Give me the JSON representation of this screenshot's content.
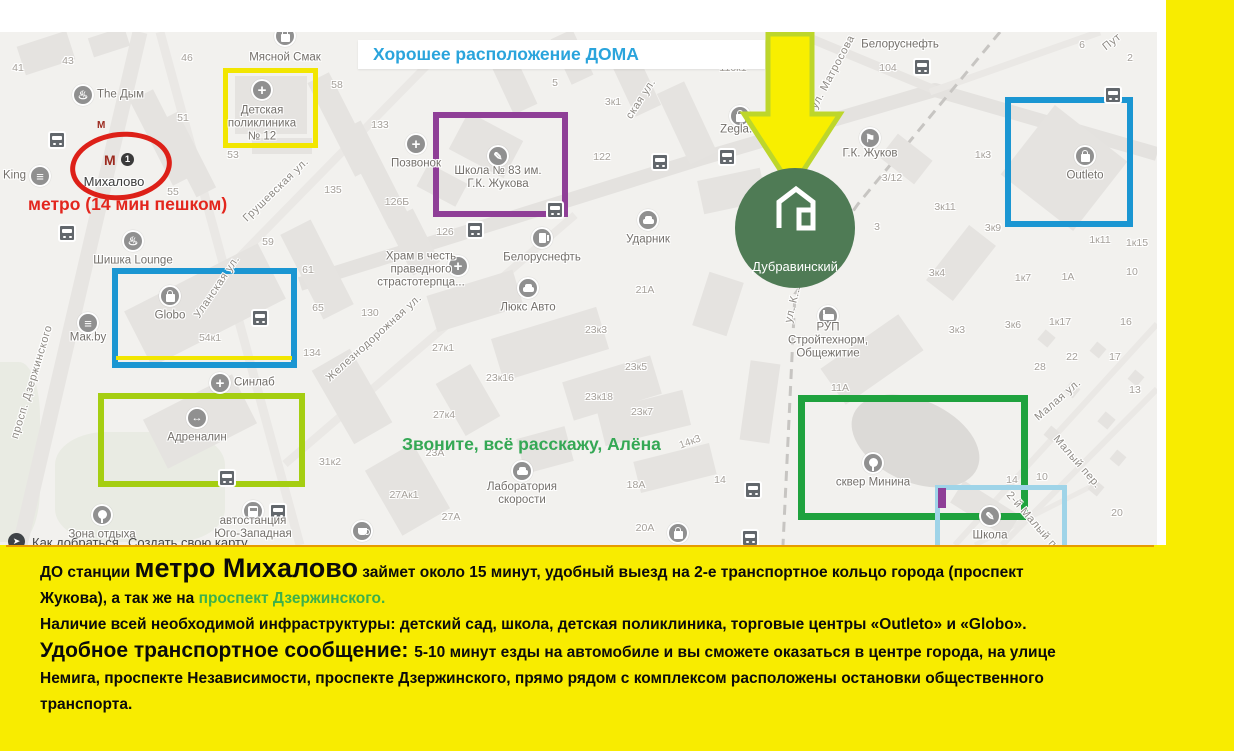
{
  "header": {
    "text": "Хорошее расположение ДОМА"
  },
  "annotations": {
    "metro_note": "метро (14 мин пешком)",
    "call_note": "Звоните, всё расскажу, Алёна",
    "complex_label": "Дубравинский"
  },
  "metro_station": {
    "name": "Михалово",
    "line_badge": "1",
    "entrance_mark": "М",
    "station_mark": "М"
  },
  "colors": {
    "accent_yellow": "#f8ec00",
    "annotation_red": "#dd2018",
    "annotation_blue": "#1b96d2",
    "annotation_purple": "#8f3f97",
    "annotation_lime": "#a5ce11",
    "annotation_green": "#1fa23e",
    "annotation_lightblue": "#9fd4e8",
    "header_blue": "#2aa4dc",
    "call_green": "#35a855",
    "complex_green": "#4f7b55",
    "arrow_fill": "#f8ef00",
    "arrow_stroke": "#bdd62b"
  },
  "map": {
    "ui": {
      "route_label": "Как добраться",
      "create_map_label": "Создать свою карту"
    },
    "streets": [
      {
        "t": "просп. Дзержинского",
        "x": 32,
        "y": 350,
        "r": -73
      },
      {
        "t": "Грушевская ул.",
        "x": 276,
        "y": 158,
        "r": -44
      },
      {
        "t": "Уланская ул.",
        "x": 217,
        "y": 255,
        "r": -56
      },
      {
        "t": "Железнодорожная ул.",
        "x": 374,
        "y": 306,
        "r": -42
      },
      {
        "t": "ская ул.",
        "x": 641,
        "y": 67,
        "r": -57
      },
      {
        "t": "ул. Матросова",
        "x": 833,
        "y": 40,
        "r": -62
      },
      {
        "t": "Пут",
        "x": 1112,
        "y": 10,
        "r": -38
      },
      {
        "t": "ул. К...",
        "x": 793,
        "y": 272,
        "r": -76
      },
      {
        "t": "Малая ул.",
        "x": 1058,
        "y": 368,
        "r": -41
      },
      {
        "t": "Малый пер.",
        "x": 1077,
        "y": 430,
        "r": 49
      },
      {
        "t": "2-й Малый п...",
        "x": 1035,
        "y": 492,
        "r": 49
      }
    ],
    "numbers": [
      {
        "t": "43",
        "x": 68,
        "y": 29
      },
      {
        "t": "41",
        "x": 18,
        "y": 36
      },
      {
        "t": "46",
        "x": 187,
        "y": 26
      },
      {
        "t": "58",
        "x": 337,
        "y": 53
      },
      {
        "t": "51",
        "x": 183,
        "y": 86
      },
      {
        "t": "133",
        "x": 380,
        "y": 93
      },
      {
        "t": "53",
        "x": 233,
        "y": 123
      },
      {
        "t": "55",
        "x": 173,
        "y": 160
      },
      {
        "t": "135",
        "x": 333,
        "y": 158
      },
      {
        "t": "59",
        "x": 268,
        "y": 210
      },
      {
        "t": "61",
        "x": 308,
        "y": 238
      },
      {
        "t": "65",
        "x": 318,
        "y": 276
      },
      {
        "t": "134",
        "x": 312,
        "y": 321
      },
      {
        "t": "126Б",
        "x": 397,
        "y": 170
      },
      {
        "t": "126",
        "x": 445,
        "y": 200
      },
      {
        "t": "122",
        "x": 602,
        "y": 125
      },
      {
        "t": "5",
        "x": 555,
        "y": 51
      },
      {
        "t": "3к1",
        "x": 613,
        "y": 70
      },
      {
        "t": "116к1",
        "x": 733,
        "y": 36
      },
      {
        "t": "104",
        "x": 888,
        "y": 36
      },
      {
        "t": "6",
        "x": 1082,
        "y": 13
      },
      {
        "t": "2",
        "x": 1130,
        "y": 26
      },
      {
        "t": "1к3",
        "x": 983,
        "y": 123
      },
      {
        "t": "3/12",
        "x": 892,
        "y": 146
      },
      {
        "t": "3к11",
        "x": 945,
        "y": 175
      },
      {
        "t": "3к9",
        "x": 993,
        "y": 196
      },
      {
        "t": "3",
        "x": 877,
        "y": 195
      },
      {
        "t": "1к11",
        "x": 1100,
        "y": 208
      },
      {
        "t": "1к15",
        "x": 1137,
        "y": 211
      },
      {
        "t": "3к4",
        "x": 937,
        "y": 241
      },
      {
        "t": "1к7",
        "x": 1023,
        "y": 246
      },
      {
        "t": "1А",
        "x": 1068,
        "y": 245
      },
      {
        "t": "10",
        "x": 1132,
        "y": 240
      },
      {
        "t": "130",
        "x": 370,
        "y": 281
      },
      {
        "t": "27к1",
        "x": 443,
        "y": 316
      },
      {
        "t": "23к16",
        "x": 500,
        "y": 346
      },
      {
        "t": "27к4",
        "x": 444,
        "y": 383
      },
      {
        "t": "23А",
        "x": 435,
        "y": 421
      },
      {
        "t": "31к2",
        "x": 330,
        "y": 430
      },
      {
        "t": "27Ак1",
        "x": 404,
        "y": 463
      },
      {
        "t": "27А",
        "x": 451,
        "y": 485
      },
      {
        "t": "23к3",
        "x": 596,
        "y": 298
      },
      {
        "t": "23к5",
        "x": 636,
        "y": 335
      },
      {
        "t": "23к18",
        "x": 599,
        "y": 365
      },
      {
        "t": "23к7",
        "x": 642,
        "y": 380
      },
      {
        "t": "21А",
        "x": 645,
        "y": 258
      },
      {
        "t": "14к3",
        "x": 690,
        "y": 410,
        "r": -20
      },
      {
        "t": "14",
        "x": 720,
        "y": 448
      },
      {
        "t": "18А",
        "x": 636,
        "y": 453
      },
      {
        "t": "20А",
        "x": 645,
        "y": 496
      },
      {
        "t": "3к3",
        "x": 957,
        "y": 298
      },
      {
        "t": "3к6",
        "x": 1013,
        "y": 293
      },
      {
        "t": "1к17",
        "x": 1060,
        "y": 290
      },
      {
        "t": "16",
        "x": 1126,
        "y": 290
      },
      {
        "t": "22",
        "x": 1072,
        "y": 325
      },
      {
        "t": "28",
        "x": 1040,
        "y": 335
      },
      {
        "t": "17",
        "x": 1115,
        "y": 325
      },
      {
        "t": "13",
        "x": 1135,
        "y": 358
      },
      {
        "t": "11А",
        "x": 840,
        "y": 356
      },
      {
        "t": "14",
        "x": 1012,
        "y": 448
      },
      {
        "t": "10",
        "x": 1042,
        "y": 445
      },
      {
        "t": "20",
        "x": 1117,
        "y": 481
      },
      {
        "t": "54к1",
        "x": 210,
        "y": 306
      }
    ],
    "pois": [
      {
        "t": "The Дым",
        "icon": "hookah",
        "x": 83,
        "y": 63,
        "side": "right"
      },
      {
        "t": "Мясной Смак",
        "icon": "bag",
        "x": 285,
        "y": 4,
        "ly": 22
      },
      {
        "t": "Детская\nполиклиника\n№ 12",
        "icon": "med",
        "x": 262,
        "y": 58
      },
      {
        "t": "Позвонок",
        "icon": "med",
        "x": 416,
        "y": 112
      },
      {
        "t": "Школа № 83 им.\nГ.К. Жукова",
        "icon": "school",
        "x": 498,
        "y": 124,
        "ly": 22
      },
      {
        "t": "Белоруснефть",
        "icon": "gas",
        "x": 542,
        "y": 206
      },
      {
        "t": "Люкс Авто",
        "icon": "car",
        "x": 528,
        "y": 256
      },
      {
        "t": "Ударник",
        "icon": "car",
        "x": 648,
        "y": 188
      },
      {
        "t": "Храм в честь\nправедного\nстрастотерпца...",
        "icon": "med",
        "x": 458,
        "y": 234,
        "lx": -37,
        "ly": 4
      },
      {
        "t": "Zegla.B",
        "icon": "bag",
        "x": 740,
        "y": 84,
        "ly": 14
      },
      {
        "t": "Белоруснефть",
        "icon": "none",
        "x": 900,
        "y": 13,
        "ly": 0
      },
      {
        "t": "Г.К. Жуков",
        "icon": "flag",
        "x": 870,
        "y": 106,
        "ly": 16
      },
      {
        "t": "Outleto",
        "icon": "bag",
        "x": 1085,
        "y": 124
      },
      {
        "t": "Шишка Lounge",
        "icon": "hookah",
        "x": 133,
        "y": 209
      },
      {
        "t": "Мак.by",
        "icon": "burger",
        "x": 88,
        "y": 291,
        "ly": 15
      },
      {
        "t": "Globo",
        "icon": "bag",
        "x": 170,
        "y": 264
      },
      {
        "t": "Синлаб",
        "icon": "med",
        "x": 220,
        "y": 351,
        "side": "right"
      },
      {
        "t": "Адреналин",
        "icon": "arrows",
        "x": 197,
        "y": 386
      },
      {
        "t": "Зона отдыха",
        "icon": "tree",
        "x": 102,
        "y": 483
      },
      {
        "t": "автостанция\nЮго-Западная",
        "icon": "busbig",
        "x": 253,
        "y": 479,
        "ly": 17
      },
      {
        "t": "Лаборатория\nскорости",
        "icon": "car",
        "x": 522,
        "y": 439,
        "ly": 23
      },
      {
        "t": "РУП\nСтройтехнорм,\nОбщежитие",
        "icon": "bed",
        "x": 828,
        "y": 284,
        "ly": 25
      },
      {
        "t": "сквер Минина",
        "icon": "tree",
        "x": 873,
        "y": 431
      },
      {
        "t": "Школа",
        "icon": "school",
        "x": 990,
        "y": 484
      },
      {
        "t": "King",
        "icon": "burger",
        "x": 40,
        "y": 144,
        "side": "left"
      },
      {
        "t": "",
        "icon": "cup",
        "x": 362,
        "y": 499
      },
      {
        "t": "",
        "icon": "bag",
        "x": 678,
        "y": 501
      }
    ],
    "bus_stops": [
      [
        57,
        108
      ],
      [
        67,
        201
      ],
      [
        660,
        130
      ],
      [
        727,
        125
      ],
      [
        555,
        178
      ],
      [
        475,
        198
      ],
      [
        922,
        35
      ],
      [
        1113,
        63
      ],
      [
        260,
        286
      ],
      [
        227,
        446
      ],
      [
        278,
        480
      ],
      [
        753,
        458
      ],
      [
        750,
        506
      ]
    ],
    "boxes": [
      {
        "name": "polyclinic",
        "x": 223,
        "y": 36,
        "w": 95,
        "h": 80,
        "c": "#f2e600",
        "bw": 5
      },
      {
        "name": "school83",
        "x": 433,
        "y": 80,
        "w": 135,
        "h": 105,
        "c": "#8f3f97",
        "bw": 6
      },
      {
        "name": "globo",
        "x": 112,
        "y": 236,
        "w": 185,
        "h": 100,
        "c": "#1b96d2",
        "bw": 6
      },
      {
        "name": "adrenalin",
        "x": 98,
        "y": 361,
        "w": 207,
        "h": 94,
        "c": "#a5ce11",
        "bw": 6
      },
      {
        "name": "outleto",
        "x": 1005,
        "y": 65,
        "w": 128,
        "h": 130,
        "c": "#1b96d2",
        "bw": 6
      },
      {
        "name": "skver-minina",
        "x": 798,
        "y": 363,
        "w": 230,
        "h": 125,
        "c": "#1fa23e",
        "bw": 7
      },
      {
        "name": "school-small",
        "x": 935,
        "y": 453,
        "w": 132,
        "h": 75,
        "c": "#9fd4e8",
        "bw": 5
      }
    ]
  },
  "footer": {
    "p1a": "ДО станции ",
    "p1_big": "метро Михалово",
    "p1b": " займет около 15 минут, удобный выезд на 2-е транспортное кольцо города (проспект\nЖукова), а так же на ",
    "p1_green": "проспект Дзержинского.",
    "p2": "Наличие всей необходимой инфраструктуры: детский сад, школа, детская поликлиника, торговые центры «Outleto» и «Globo».",
    "p3_big": "Удобное транспортное сообщение: ",
    "p3": "5-10 минут езды на автомобиле и вы сможете оказаться в центре города, на улице\nНемига, проспекте Независимости, проспекте Дзержинского, прямо рядом с комплексом расположены остановки общественного\nтранспорта."
  }
}
